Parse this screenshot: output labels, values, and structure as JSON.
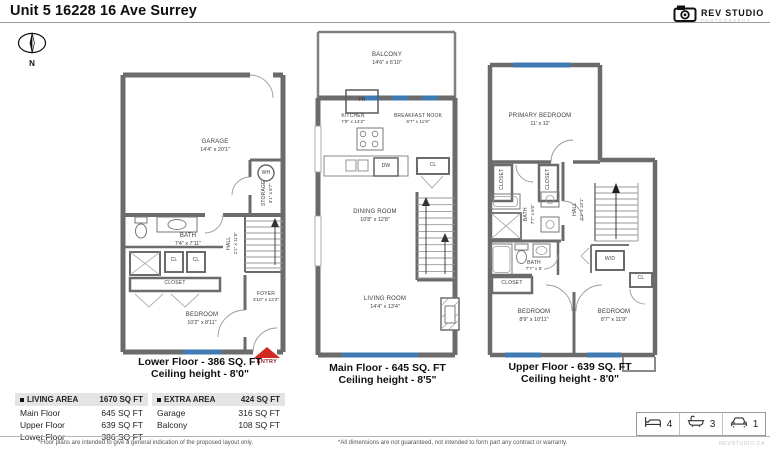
{
  "header": {
    "title": "Unit 5 16228 16 Ave Surrey",
    "logo_name": "REV STUDIO",
    "logo_sub": "PHOTOGRAPHY",
    "compass": "N"
  },
  "colors": {
    "entry_red": "#cf2b24",
    "window_blue": "#3f7ab3",
    "wall_gray": "#6b6b6b"
  },
  "floors": {
    "lower": {
      "caption1": "Lower Floor - 386 SQ. FT",
      "caption2": "Ceiling height - 8'0\"",
      "entry": "ENTRY",
      "garage": {
        "name": "GARAGE",
        "dims": "14'4\" x 20'1\""
      },
      "wh": "WH",
      "storage": {
        "name": "STORAGE",
        "dims": "3'1\" x 8'7\""
      },
      "bath": {
        "name": "BATH",
        "dims": "7'4\" x 7'11\""
      },
      "hall": {
        "name": "HALL",
        "dims": "2'1\" x 11'5\""
      },
      "cl1": "CL",
      "cl2": "CL",
      "closet": "CLOSET",
      "foyer": {
        "name": "FOYER",
        "dims": "3'10\" x 12'3\""
      },
      "bedroom": {
        "name": "BEDROOM",
        "dims": "10'2\" x 8'11\""
      }
    },
    "main": {
      "caption1": "Main Floor - 645 SQ. FT",
      "caption2": "Ceiling height - 8'5\"",
      "balcony": {
        "name": "BALCONY",
        "dims": "14'6\" x 6'10\""
      },
      "fr": "FR",
      "kitchen": {
        "name": "KITCHEN",
        "dims": "7'9\" x 14'2\""
      },
      "nook": {
        "name": "BREAKFAST NOOK",
        "dims": "6'7\" x 11'9\""
      },
      "dw": "DW",
      "cl": "CL",
      "dining": {
        "name": "DINING ROOM",
        "dims": "10'8\" x 12'8\""
      },
      "living": {
        "name": "LIVING ROOM",
        "dims": "14'4\" x 13'4\""
      }
    },
    "upper": {
      "caption1": "Upper Floor - 639 SQ. FT",
      "caption2": "Ceiling height - 8'0\"",
      "primary": {
        "name": "PRIMARY BEDROOM",
        "dims": "11' x 12'"
      },
      "closet1": "CLOSET",
      "closet2": "CLOSET",
      "bath1": {
        "name": "BATH",
        "dims": "7'7\" x 6'0\""
      },
      "hall": {
        "name": "HALL",
        "dims": "3'1\" x 15'1\""
      },
      "bath2": {
        "name": "BATH",
        "dims": "7'7\" x 5'"
      },
      "wd": "W/D",
      "closet3": "CLOSET",
      "cl": "CL",
      "bedroom1": {
        "name": "BEDROOM",
        "dims": "8'9\" x 10'11\""
      },
      "bedroom2": {
        "name": "BEDROOM",
        "dims": "8'7\" x 11'9\""
      }
    }
  },
  "tables": {
    "living": {
      "title": "LIVING AREA",
      "total": "1670 SQ FT",
      "rows": [
        {
          "label": "Main Floor",
          "value": "645 SQ FT"
        },
        {
          "label": "Upper Floor",
          "value": "639 SQ FT"
        },
        {
          "label": "Lower Floor",
          "value": "386 SQ FT"
        }
      ]
    },
    "extra": {
      "title": "EXTRA AREA",
      "total": "424 SQ FT",
      "rows": [
        {
          "label": "Garage",
          "value": "316 SQ FT"
        },
        {
          "label": "Balcony",
          "value": "108 SQ FT"
        }
      ]
    }
  },
  "stats": {
    "beds": "4",
    "baths": "3",
    "parking": "1"
  },
  "footer": {
    "note_left": "*Floor plans are intended to give a general indication of the proposed layout only.",
    "note_right": "*All dimensions are not guaranteed, not intended to form part any contract or warranty.",
    "site": "REVSTUDIO.CA"
  }
}
